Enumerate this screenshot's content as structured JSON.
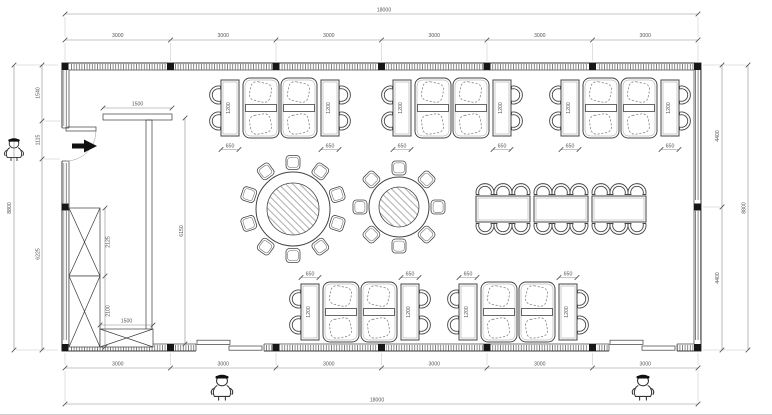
{
  "drawing": {
    "kind": "architectural floor plan - restaurant dining room furniture layout",
    "units": "mm",
    "colors": {
      "line": "#3a3a3a",
      "dim_text": "#555555",
      "solid_fill": "#161616"
    },
    "dimensions": {
      "overall_width": "18000",
      "overall_height": "8800",
      "bay": "3000",
      "left_segments": [
        "1540",
        "1115",
        "6225"
      ],
      "right_segments": [
        "4400",
        "4400"
      ],
      "table_width": "650",
      "table_length": "1200",
      "counter_length": "1500",
      "counter_run": "6150",
      "cabinet_upper": "2125",
      "cabinet_lower": "2100",
      "cabinet_bottom_width": "1500"
    },
    "furniture": {
      "booth_clusters_top": 3,
      "booth_clusters_bottom": 2,
      "booth_sofas_per_cluster": 2,
      "two_seat_tables_per_cluster": 2,
      "round_table_large_seats": 10,
      "round_table_small_seats": 8,
      "banquet_tables": 3,
      "banquet_seats": 18,
      "x_cabinets": 3,
      "person_figures": 3
    },
    "icons": {
      "person_figure": "small cartoon person with cap standing at entrance",
      "entry_arrow": "solid black arrow marking entry direction",
      "window_hatch": "dense tick hatching along exterior walls",
      "column_marker": "solid black square at structural grid points"
    }
  }
}
